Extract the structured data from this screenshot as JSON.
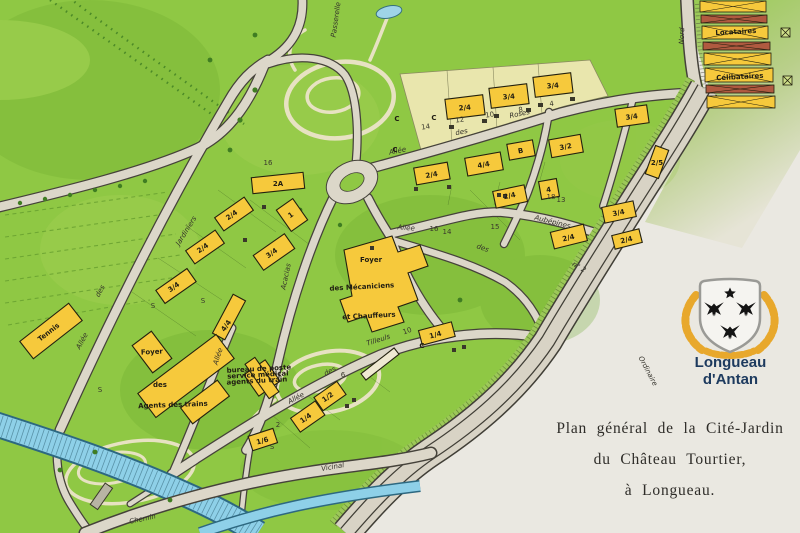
{
  "title_block": {
    "line1": "Plan général de la Cité-Jardin",
    "line2": "du Château Tourtier,",
    "line3": "à Longueau."
  },
  "logo": {
    "line1": "Longueau",
    "line2": "d'Antan",
    "colors": {
      "navy": "#1d3a5e",
      "gold": "#e8a82c",
      "shield": "#f5f4f0",
      "charges": "#141414"
    }
  },
  "map": {
    "colors": {
      "paper": "#eae8e1",
      "grass": "#8fc844",
      "grass_dark": "#6cab2d",
      "grass_light": "#aed45a",
      "building_yellow": "#f6c93c",
      "road_fill": "#dcd7c9",
      "road_edge": "#45423a",
      "water": "#8ed0e8",
      "cream_block": "#e9e6ad",
      "barrack_red": "#b05a40"
    },
    "labels": [
      {
        "t": "Allée",
        "x": 398,
        "y": 153,
        "r": -12,
        "c": "s"
      },
      {
        "t": "des",
        "x": 462,
        "y": 134,
        "r": -12,
        "fs": 5.5,
        "c": "s"
      },
      {
        "t": "Roses",
        "x": 520,
        "y": 116,
        "r": -12,
        "c": "s"
      },
      {
        "t": "Allée",
        "x": 406,
        "y": 230,
        "r": 4,
        "c": "s"
      },
      {
        "t": "des",
        "x": 482,
        "y": 250,
        "r": 20,
        "fs": 5.5,
        "c": "s"
      },
      {
        "t": "Aubépines",
        "x": 552,
        "y": 224,
        "r": 14,
        "c": "s"
      },
      {
        "t": "Allée",
        "x": 297,
        "y": 400,
        "r": -28,
        "c": "s"
      },
      {
        "t": "des",
        "x": 331,
        "y": 373,
        "r": -30,
        "fs": 5.5,
        "c": "s"
      },
      {
        "t": "Tilleuls",
        "x": 379,
        "y": 342,
        "r": -18,
        "c": "s"
      },
      {
        "t": "Allée",
        "x": 84,
        "y": 342,
        "r": -62,
        "c": "s"
      },
      {
        "t": "des",
        "x": 102,
        "y": 292,
        "r": -62,
        "fs": 5.5,
        "c": "s"
      },
      {
        "t": "Jardiniers",
        "x": 188,
        "y": 232,
        "r": -58,
        "c": "s"
      },
      {
        "t": "Allée",
        "x": 220,
        "y": 357,
        "r": -72,
        "fs": 6,
        "c": "s"
      },
      {
        "t": "Acacias",
        "x": 288,
        "y": 277,
        "r": -78,
        "c": "s"
      },
      {
        "t": "Chemin",
        "x": 143,
        "y": 521,
        "r": -12,
        "c": "s"
      },
      {
        "t": "Vicinal",
        "x": 333,
        "y": 469,
        "r": -10,
        "c": "s"
      },
      {
        "t": "Nord",
        "x": 684,
        "y": 36,
        "r": -88,
        "fs": 5.5,
        "c": "s"
      },
      {
        "t": "n° 2",
        "x": 578,
        "y": 269,
        "r": 30,
        "fs": 5.5,
        "c": "s"
      },
      {
        "t": "Ordinaire",
        "x": 646,
        "y": 372,
        "r": 62,
        "fs": 6,
        "c": "s",
        "col": "#8d8d85"
      },
      {
        "t": "Passerelle",
        "x": 338,
        "y": 20,
        "r": -82,
        "fs": 5.5,
        "c": "s"
      },
      {
        "t": "2A",
        "x": 278,
        "y": 186,
        "r": 0,
        "c": "b"
      },
      {
        "t": "2/4",
        "x": 233,
        "y": 217,
        "r": -35,
        "c": "b"
      },
      {
        "t": "1",
        "x": 292,
        "y": 217,
        "r": -35,
        "fs": 6.5,
        "c": "b"
      },
      {
        "t": "2/4",
        "x": 204,
        "y": 250,
        "r": -35,
        "c": "b"
      },
      {
        "t": "3/4",
        "x": 273,
        "y": 255,
        "r": -35,
        "c": "b"
      },
      {
        "t": "3/4",
        "x": 175,
        "y": 289,
        "r": -35,
        "c": "b"
      },
      {
        "t": "4/4",
        "x": 228,
        "y": 327,
        "r": -55,
        "c": "b"
      },
      {
        "t": "Tennis",
        "x": 50,
        "y": 334,
        "r": -38,
        "fs": 5.5,
        "c": "b"
      },
      {
        "t": "Foyer",
        "x": 152,
        "y": 354,
        "r": -3,
        "fs": 6.5,
        "c": "b"
      },
      {
        "t": "des",
        "x": 160,
        "y": 387,
        "r": 0,
        "fs": 5.5,
        "c": "b"
      },
      {
        "t": "Agents des trains",
        "x": 173,
        "y": 407,
        "r": -2,
        "fs": 4.8,
        "c": "b"
      },
      {
        "t": "Foyer",
        "x": 371,
        "y": 262,
        "r": 0,
        "fs": 6.5,
        "c": "b"
      },
      {
        "t": "des Mécaniciens",
        "x": 362,
        "y": 289,
        "r": -3,
        "fs": 6.2,
        "c": "b"
      },
      {
        "t": "et Chauffeurs",
        "x": 369,
        "y": 318,
        "r": -3,
        "fs": 6.2,
        "c": "b"
      },
      {
        "t": "bureau de poste",
        "x": 259,
        "y": 371,
        "r": -3,
        "fs": 4,
        "c": "b"
      },
      {
        "t": "service médical",
        "x": 258,
        "y": 377,
        "r": -3,
        "fs": 4,
        "c": "b"
      },
      {
        "t": "agents du train",
        "x": 257,
        "y": 383,
        "r": -3,
        "fs": 4,
        "c": "b"
      },
      {
        "t": "1/4",
        "x": 436,
        "y": 337,
        "r": -15,
        "c": "b"
      },
      {
        "t": "C",
        "x": 422,
        "y": 348,
        "r": 0,
        "fs": 5.5,
        "c": "b"
      },
      {
        "t": "2/4",
        "x": 465,
        "y": 110,
        "r": -5,
        "c": "b"
      },
      {
        "t": "3/4",
        "x": 509,
        "y": 99,
        "r": -5,
        "c": "b"
      },
      {
        "t": "3/4",
        "x": 553,
        "y": 88,
        "r": -5,
        "c": "b"
      },
      {
        "t": "C",
        "x": 434,
        "y": 120,
        "r": 0,
        "fs": 5,
        "c": "b"
      },
      {
        "t": "C",
        "x": 397,
        "y": 121,
        "r": 0,
        "fs": 5,
        "c": "b"
      },
      {
        "t": "C",
        "x": 395,
        "y": 152,
        "r": 0,
        "fs": 5,
        "c": "b"
      },
      {
        "t": "2/4",
        "x": 432,
        "y": 177,
        "r": -10,
        "c": "b"
      },
      {
        "t": "4/4",
        "x": 484,
        "y": 167,
        "r": -10,
        "c": "b"
      },
      {
        "t": "B",
        "x": 521,
        "y": 153,
        "r": -10,
        "fs": 6.5,
        "c": "b"
      },
      {
        "t": "3/2",
        "x": 566,
        "y": 149,
        "r": -10,
        "c": "b"
      },
      {
        "t": "2/4",
        "x": 510,
        "y": 198,
        "r": -12,
        "c": "b"
      },
      {
        "t": "4",
        "x": 549,
        "y": 192,
        "r": -10,
        "fs": 6,
        "c": "b"
      },
      {
        "t": "2/4",
        "x": 569,
        "y": 240,
        "r": -14,
        "c": "b"
      },
      {
        "t": "3/4",
        "x": 619,
        "y": 215,
        "r": -12,
        "c": "b"
      },
      {
        "t": "2/4",
        "x": 627,
        "y": 242,
        "r": -14,
        "fs": 6,
        "c": "b"
      },
      {
        "t": "3/4",
        "x": 632,
        "y": 119,
        "r": -8,
        "c": "b"
      },
      {
        "t": "2/5",
        "x": 657,
        "y": 165,
        "r": 0,
        "fs": 6,
        "c": "b"
      },
      {
        "t": "1/2",
        "x": 329,
        "y": 399,
        "r": -35,
        "c": "b"
      },
      {
        "t": "1/4",
        "x": 307,
        "y": 420,
        "r": -35,
        "c": "b"
      },
      {
        "t": "1/6",
        "x": 263,
        "y": 443,
        "r": -15,
        "c": "b"
      },
      {
        "t": "Locataires",
        "x": 736,
        "y": 34,
        "r": -3,
        "fs": 4.6,
        "c": "b"
      },
      {
        "t": "Célibataires",
        "x": 740,
        "y": 79,
        "r": -3,
        "fs": 4.6,
        "c": "b"
      },
      {
        "t": "S",
        "x": 153,
        "y": 308,
        "r": 0,
        "fs": 6,
        "c": "p"
      },
      {
        "t": "S",
        "x": 203,
        "y": 303,
        "r": 0,
        "fs": 6,
        "c": "p"
      },
      {
        "t": "S",
        "x": 100,
        "y": 392,
        "r": 0,
        "fs": 7,
        "c": "p"
      },
      {
        "t": "S",
        "x": 272,
        "y": 449,
        "r": 0,
        "fs": 6,
        "c": "p"
      },
      {
        "t": "14",
        "x": 426,
        "y": 129,
        "r": -8,
        "fs": 4.2,
        "c": "p"
      },
      {
        "t": "12",
        "x": 460,
        "y": 122,
        "r": -8,
        "fs": 4.2,
        "c": "p"
      },
      {
        "t": "10",
        "x": 490,
        "y": 117,
        "r": -8,
        "fs": 4.2,
        "c": "p"
      },
      {
        "t": "8",
        "x": 521,
        "y": 112,
        "r": -8,
        "fs": 4.2,
        "c": "p"
      },
      {
        "t": "4",
        "x": 552,
        "y": 106,
        "r": -8,
        "fs": 4.2,
        "c": "p"
      },
      {
        "t": "16",
        "x": 434,
        "y": 231,
        "r": 0,
        "fs": 4,
        "c": "p"
      },
      {
        "t": "14",
        "x": 447,
        "y": 234,
        "r": 0,
        "fs": 4,
        "c": "p"
      },
      {
        "t": "15",
        "x": 495,
        "y": 229,
        "r": 0,
        "fs": 4,
        "c": "p"
      },
      {
        "t": "18",
        "x": 551,
        "y": 199,
        "r": 0,
        "fs": 4,
        "c": "p"
      },
      {
        "t": "13",
        "x": 561,
        "y": 202,
        "r": 0,
        "fs": 4,
        "c": "p"
      },
      {
        "t": "10",
        "x": 408,
        "y": 333,
        "r": -20,
        "fs": 4.2,
        "c": "p"
      },
      {
        "t": "6",
        "x": 343,
        "y": 377,
        "r": 0,
        "fs": 4.2,
        "c": "p"
      },
      {
        "t": "2",
        "x": 278,
        "y": 427,
        "r": 0,
        "fs": 4.2,
        "c": "p"
      },
      {
        "t": "16",
        "x": 268,
        "y": 165,
        "r": 0,
        "fs": 4.2,
        "c": "p"
      }
    ]
  }
}
